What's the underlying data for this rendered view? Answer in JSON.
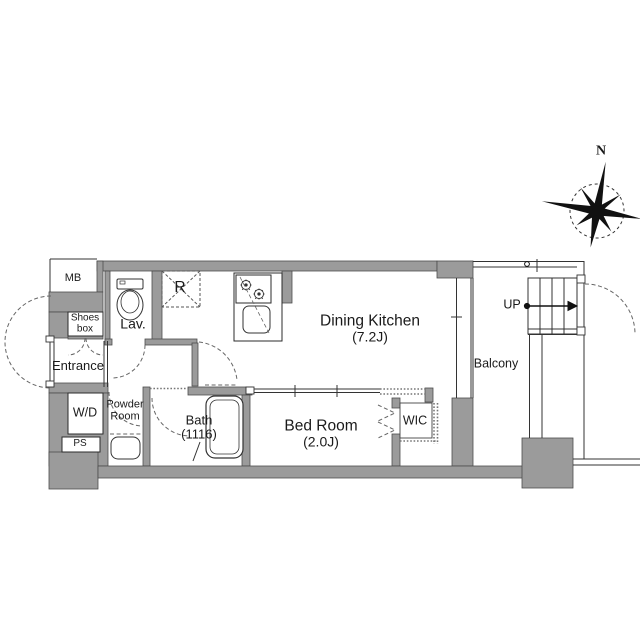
{
  "plan": {
    "title_hint": "apartment floor plan",
    "labels": {
      "mb": "MB",
      "shoes_box_line1": "Shoes",
      "shoes_box_line2": "box",
      "lavatory": "Lav.",
      "refrigerator": "R",
      "entrance": "Entrance",
      "washer_dryer": "W/D",
      "pipe_space": "PS",
      "powder_line1": "Powder",
      "powder_line2": "Room",
      "bath": "Bath",
      "bath_size": "(1116)",
      "bedroom": "Bed Room",
      "bedroom_size": "(2.0J)",
      "dining_kitchen": "Dining Kitchen",
      "dining_kitchen_size": "(7.2J)",
      "wic": "WIC",
      "balcony": "Balcony",
      "stairs_up": "UP",
      "compass_north": "N"
    },
    "colors": {
      "wall_fill": "#9b9b9b",
      "wall_edge": "#4d4d4d",
      "line": "#333333",
      "dash": "#666666",
      "text": "#1a1a1a"
    }
  }
}
